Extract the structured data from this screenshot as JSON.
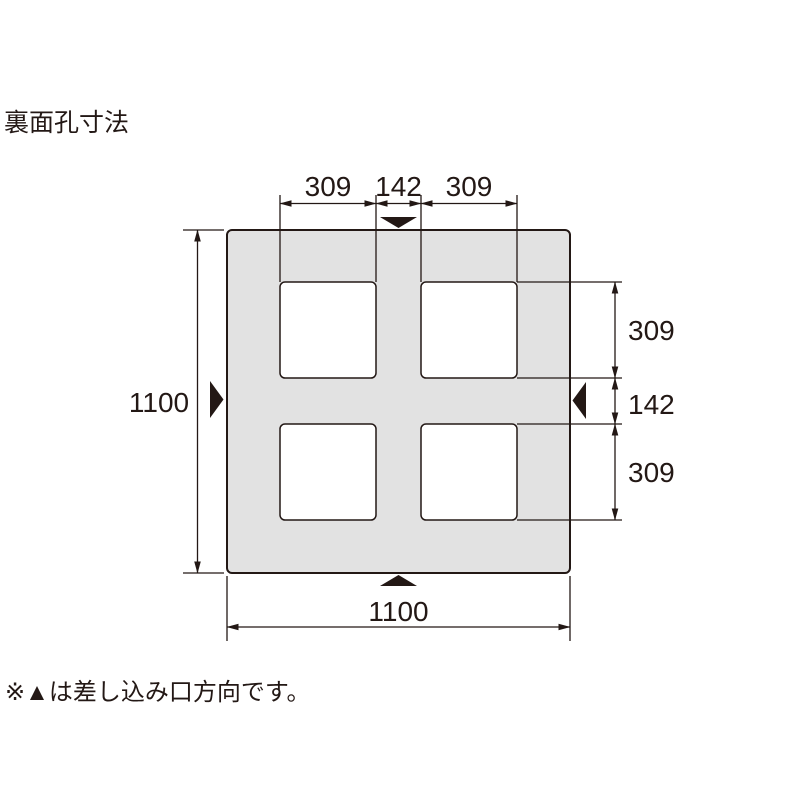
{
  "title": "裏面孔寸法",
  "note": "※▲は差し込み口方向です。",
  "dims": {
    "top": [
      "309",
      "142",
      "309"
    ],
    "left": "1100",
    "right": [
      "309",
      "142",
      "309"
    ],
    "bottom": "1100"
  },
  "icons": {
    "insertion_direction_triangle": "▲"
  },
  "colors": {
    "line": "#231815",
    "pallet_fill": "#e2e2e2",
    "hole_fill": "#ffffff",
    "background": "#ffffff"
  }
}
